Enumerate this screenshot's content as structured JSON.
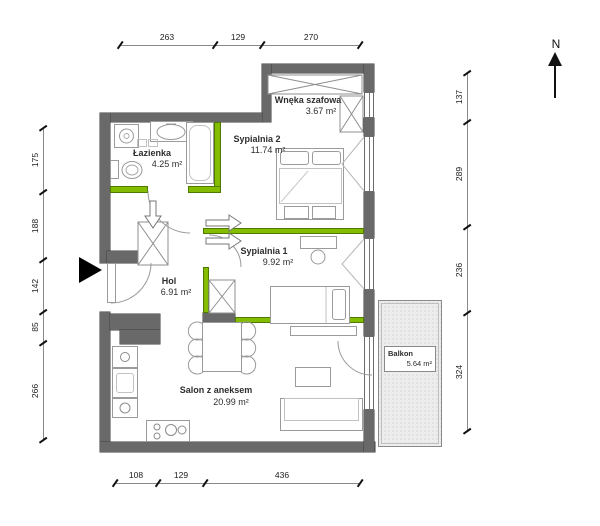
{
  "plan": {
    "title": "apartment floor plan",
    "north_label": "N",
    "rooms": [
      {
        "name": "Wnęka szafowa",
        "area": "3.67 m²"
      },
      {
        "name": "Sypialnia 2",
        "area": "11.74 m²"
      },
      {
        "name": "Łazienka",
        "area": "4.25 m²"
      },
      {
        "name": "Sypialnia 1",
        "area": "9.92 m²"
      },
      {
        "name": "Hol",
        "area": "6.91 m²"
      },
      {
        "name": "Salon z aneksem",
        "area": "20.99 m²"
      },
      {
        "name": "Balkon",
        "area": "5.64 m²"
      }
    ],
    "dimensions": {
      "top": [
        "263",
        "129",
        "270"
      ],
      "bottom": [
        "108",
        "129",
        "436"
      ],
      "left": [
        "175",
        "188",
        "142",
        "85",
        "266"
      ],
      "right": [
        "137",
        "289",
        "236",
        "324"
      ]
    },
    "colors": {
      "wall": "#696969",
      "partition": "#84bd00",
      "balcony_dots": "#c7c7c7"
    },
    "markers": {
      "north_arrow": "north-arrow",
      "entrance": "entrance-arrow"
    }
  }
}
